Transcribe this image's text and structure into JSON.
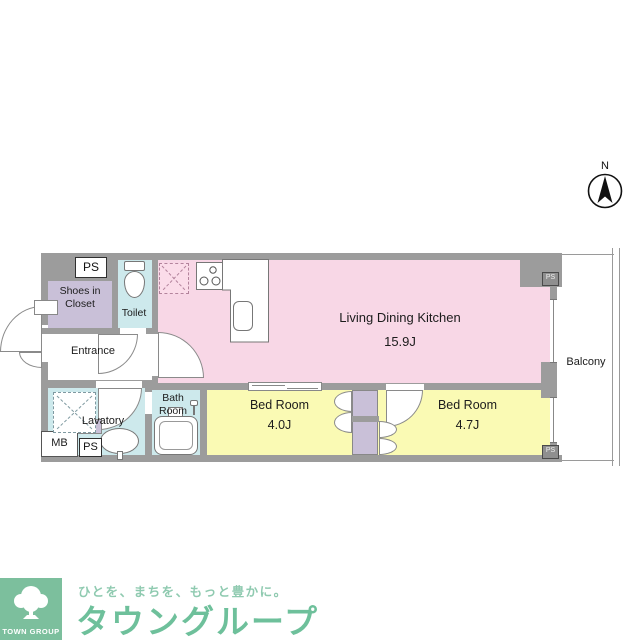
{
  "compass": {
    "north": "N"
  },
  "plan": {
    "wall_color": "#9c9c9c",
    "rooms": {
      "ldk": {
        "name": "Living Dining Kitchen",
        "size": "15.9J",
        "color": "#f8d7e6"
      },
      "bedroom1": {
        "name": "Bed Room",
        "size": "4.0J",
        "color": "#fafab4"
      },
      "bedroom2": {
        "name": "Bed Room",
        "size": "4.7J",
        "color": "#fafab4"
      },
      "entrance": {
        "name": "Entrance"
      },
      "toilet": {
        "name": "Toilet",
        "color": "#cde9ec"
      },
      "shoes_closet": {
        "name": "Shoes in Closet",
        "color": "#c9c0d8"
      },
      "bathroom": {
        "name": "Bath Room",
        "color": "#cde9ec"
      },
      "lavatory": {
        "name": "Lavatory",
        "color": "#cde9ec"
      },
      "balcony": {
        "name": "Balcony"
      }
    },
    "labels": {
      "ps": "PS",
      "mb": "MB"
    }
  },
  "footer": {
    "group_name": "TOWN GROUP",
    "tagline": "ひとを、まちを、もっと豊かに。",
    "brand": "タウングループ",
    "brand_color": "#6ec09b",
    "logo_bg": "#7cbf9d"
  }
}
